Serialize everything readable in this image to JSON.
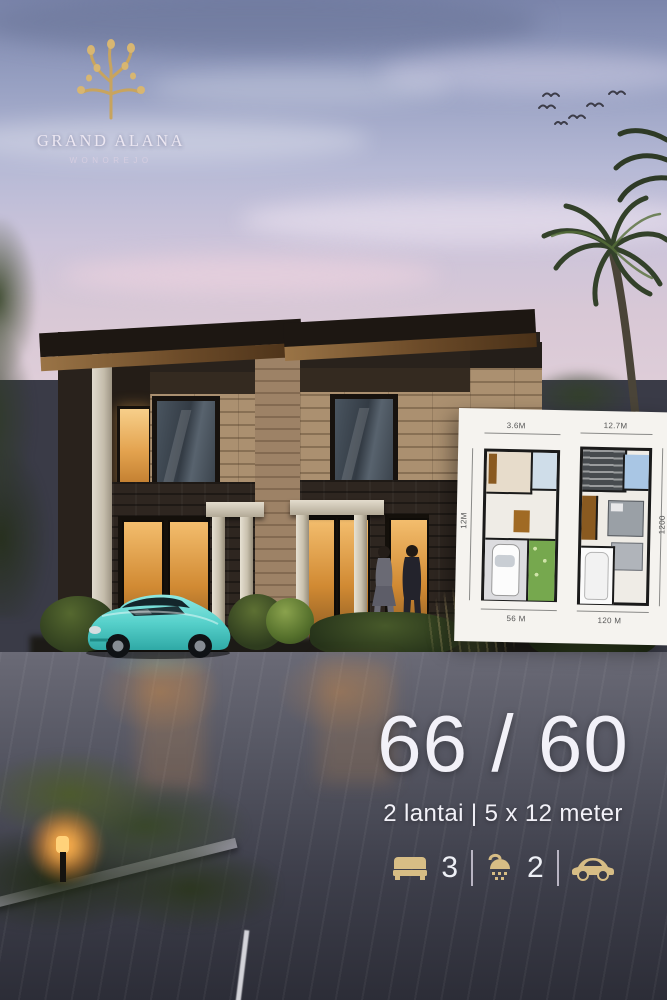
{
  "brand": {
    "name": "GRAND ALANA",
    "subtitle": "WONOREJO",
    "logo_icon": "tree-icon"
  },
  "floorplan_card": {
    "left_plan": {
      "top_dim": "3.6M",
      "left_dim": "12M",
      "bottom_dim": "56 M"
    },
    "right_plan": {
      "top_dim": "12.7M",
      "right_dim": "1200",
      "bottom_dim": "120 M"
    }
  },
  "specs": {
    "headline": "66 / 60",
    "subline": "2 lantai | 5 x 12 meter",
    "features": [
      {
        "icon": "bed-icon",
        "value": "3"
      },
      {
        "icon": "shower-icon",
        "value": "2"
      },
      {
        "icon": "car-icon",
        "value": ""
      }
    ]
  },
  "colors": {
    "gold": "#d7bd85",
    "text_light": "#f2f1f8",
    "sky_top": "#7b85ab",
    "card_bg": "#f5f3ef",
    "car_teal": "#5ad2cd",
    "wood": "#ab9070"
  }
}
